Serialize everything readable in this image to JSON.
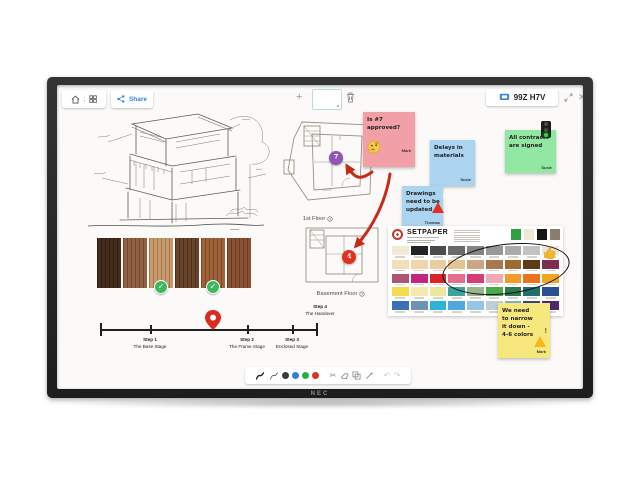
{
  "bezel": {
    "brand": "NEC"
  },
  "topbar": {
    "share_label": "Share",
    "session_badge": "99Z H7V"
  },
  "canvas": {
    "floorplans": {
      "first": {
        "label": "1st Floor",
        "marker": "7"
      },
      "basement": {
        "label": "Basement Floor",
        "marker": "4"
      }
    },
    "timeline": {
      "steps": [
        {
          "step": "Step 1",
          "name": "The Base Stage"
        },
        {
          "step": "Step 2",
          "name": "The Frame Stage"
        },
        {
          "step": "Step 3",
          "name": "Enclosed Stage"
        },
        {
          "step": "Step 4",
          "name": "The Handover"
        }
      ]
    },
    "stickies": {
      "pink": {
        "text": "Is #7 approved?",
        "author": "Mark",
        "color": "#f2a0a8"
      },
      "blue_delays": {
        "text": "Delays in materials",
        "author": "Susie",
        "color": "#abd4f0"
      },
      "blue_drawings": {
        "text": "Drawings need to be updated",
        "author": "Thomas",
        "color": "#abd4f0"
      },
      "green": {
        "text": "All contracts are signed",
        "author": "Susie",
        "color": "#92e8a3"
      },
      "yellow": {
        "text": "We need to narrow it down - 4-6 colors",
        "author": "Mark",
        "color": "#f6e87c"
      }
    },
    "wood": {
      "colors": [
        "#3a2112",
        "#8a5a38",
        "#c49463",
        "#5f3a20",
        "#9a5a2e",
        "#84492a"
      ],
      "checked": [
        2,
        4
      ],
      "check_color": "#3cb85c"
    },
    "palette_card": {
      "title": "SETPAPER",
      "logo_color": "#c0392b",
      "header_swatches": [
        "#2f9e44",
        "#efe8d9",
        "#161616",
        "#877e6f"
      ],
      "rows": [
        [
          "#f2e9d6",
          "#232323",
          "#4c4c4c",
          "#6a6a6a",
          "#848484",
          "#989898",
          "#ababab",
          "#c2c2c2",
          "#ece5d8"
        ],
        [
          "#f3debb",
          "#efd6ad",
          "#e9cda1",
          "#e2c495",
          "#cba585",
          "#a8764f",
          "#a06a2f",
          "#5e3a17",
          "#7d2d4e"
        ],
        [
          "#ad5576",
          "#c2267c",
          "#dc2428",
          "#e46e8e",
          "#d83a74",
          "#f2a9b4",
          "#f29a2a",
          "#ea7220",
          "#f2a51f"
        ],
        [
          "#f2dc4e",
          "#f5e9ad",
          "#eee79a",
          "#3da49c",
          "#9cb489",
          "#49a94e",
          "#2b7a4f",
          "#206e6d",
          "#2c4e92"
        ],
        [
          "#3c70b4",
          "#6e92b6",
          "#2ab4d8",
          "#4fa8e0",
          "#92c6e4",
          "#becfd8",
          "#7fb2c4",
          "#31497c",
          "#4d2a70"
        ]
      ]
    },
    "annotation_colors": {
      "arrow": "#c82a1a",
      "ellipse": "#111111"
    },
    "markers": {
      "purple": "#8f56b8",
      "red": "#e0301e"
    }
  },
  "bottom_toolbar": {
    "pen_colors": [
      "#3b3b3b",
      "#2f7de0",
      "#27ae45",
      "#d63324"
    ]
  }
}
